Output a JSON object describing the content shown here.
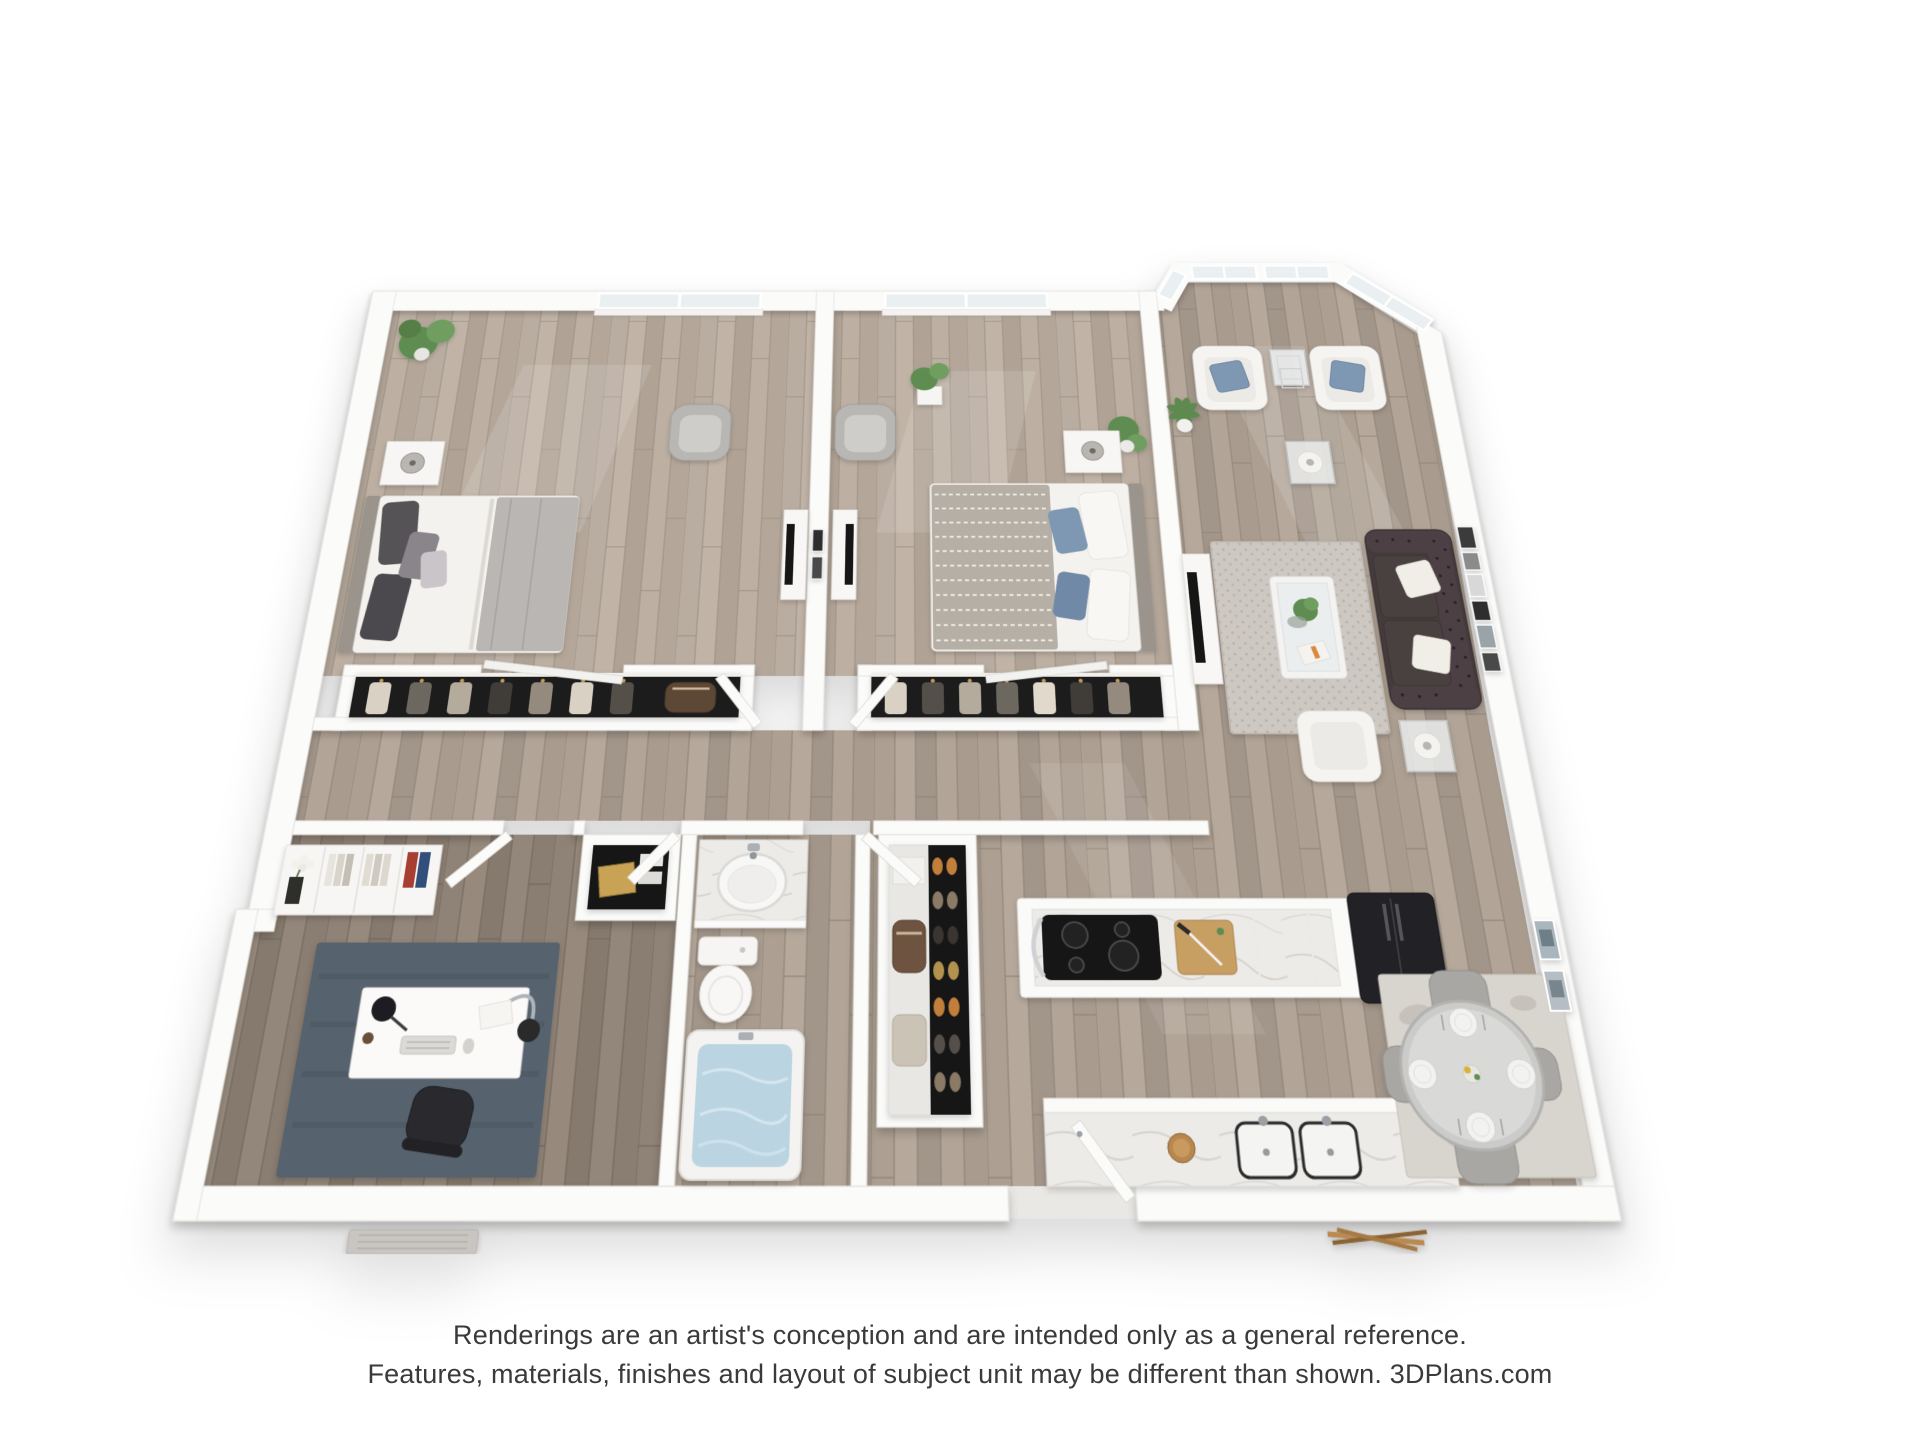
{
  "disclaimer": {
    "line1": "Renderings are an artist's conception and are intended only as a general reference.",
    "line2": "Features, materials, finishes and layout of subject unit may be different than shown. 3DPlans.com",
    "brand": "3DPlans.com"
  },
  "palette": {
    "background": "#ffffff",
    "wall": "#fbfbfa",
    "wood_main": "#ada092",
    "wood_bedroom": "#b9aca0",
    "wood_office": "#8f8276",
    "marble": "#edebe8",
    "accent_pillow_blue": "#7e98b4",
    "sofa_leather": "#453a3c",
    "rug_living": "#cdc8c2",
    "rug_office": "#57636e",
    "rug_dining": "#d8d4ce",
    "tub_water": "#bad5e1",
    "plant_green": "#5f8d51",
    "cutting_board": "#c89f63",
    "gold_box": "#c8a355",
    "text": "#3a3a3a"
  },
  "scene": {
    "type": "3d-floor-plan-render",
    "view": "top-down dollhouse",
    "rooms": [
      {
        "name": "bedroom-1",
        "furniture": [
          "skylight window",
          "potted plant",
          "bed with dark gray pillows",
          "nightstand with lamp",
          "gray accent chair",
          "tv console",
          "closet with hanging clothes"
        ]
      },
      {
        "name": "bedroom-2",
        "furniture": [
          "skylight window",
          "gray accent chair",
          "media console with tv",
          "plant on stand",
          "corner floor plant",
          "bed with patterned throw and blue pillows",
          "nightstand with lamp",
          "closet with hanging clothes"
        ]
      },
      {
        "name": "living-room",
        "furniture": [
          "bay windows",
          "two white armchairs with blue pillows",
          "glass nesting tables",
          "palm plant",
          "tv console",
          "speckled area rug",
          "glass coffee table with plant and magazine",
          "tufted leather sofa with white pillows",
          "two end tables with lamps",
          "white armchair",
          "gallery wall frames"
        ]
      },
      {
        "name": "kitchen",
        "furniture": [
          "peninsula counter",
          "black cooktop",
          "cutting board with knife",
          "dark refrigerator",
          "marble counter with double sink",
          "wood bowl"
        ]
      },
      {
        "name": "dining-area",
        "furniture": [
          "distressed rug",
          "round glass table with four place settings",
          "four gray chairs",
          "two wall art frames"
        ]
      },
      {
        "name": "bathroom",
        "furniture": [
          "marble vanity with oval sink",
          "toilet",
          "bathtub with water",
          "door"
        ]
      },
      {
        "name": "office-den",
        "furniture": [
          "white bookshelf with flowers and binders",
          "blue rug",
          "white desk with lamps and keyboard",
          "office chair",
          "doormat"
        ]
      },
      {
        "name": "hallway",
        "furniture": [
          "bedroom doors",
          "hall closet with gold box",
          "shoe wardrobe with bags and shoes",
          "entry door"
        ]
      }
    ]
  }
}
